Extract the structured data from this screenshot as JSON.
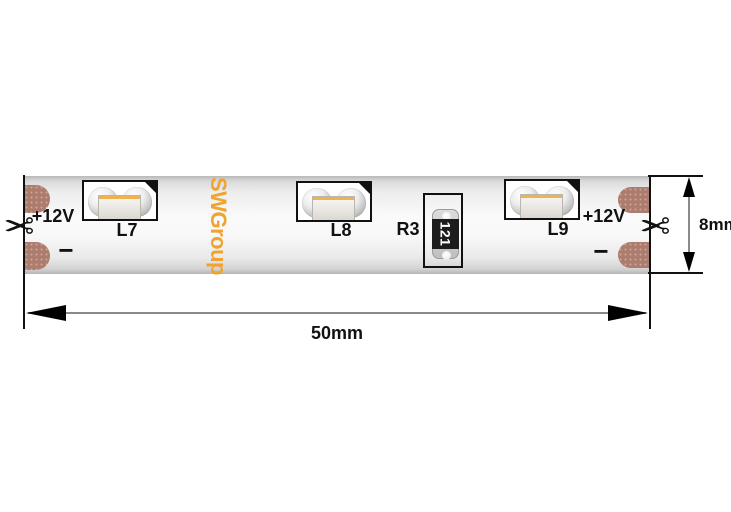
{
  "colors": {
    "brand_orange": "#F0A32F",
    "copper_pad": "#AB7C6F",
    "line_black": "#111111",
    "dimension_gray": "#8A8A8A"
  },
  "strip": {
    "brand": "SWGroup",
    "terminals": {
      "left": {
        "positive": "+12V",
        "negative": "−"
      },
      "right": {
        "positive": "+12V",
        "negative": "−"
      }
    },
    "leds": [
      {
        "label": "L7"
      },
      {
        "label": "L8"
      },
      {
        "label": "L9"
      }
    ],
    "resistor": {
      "label": "R3",
      "marking": "121"
    }
  },
  "dimensions": {
    "width": "50mm",
    "height": "8mm"
  },
  "icons": {
    "scissors": "✂"
  }
}
